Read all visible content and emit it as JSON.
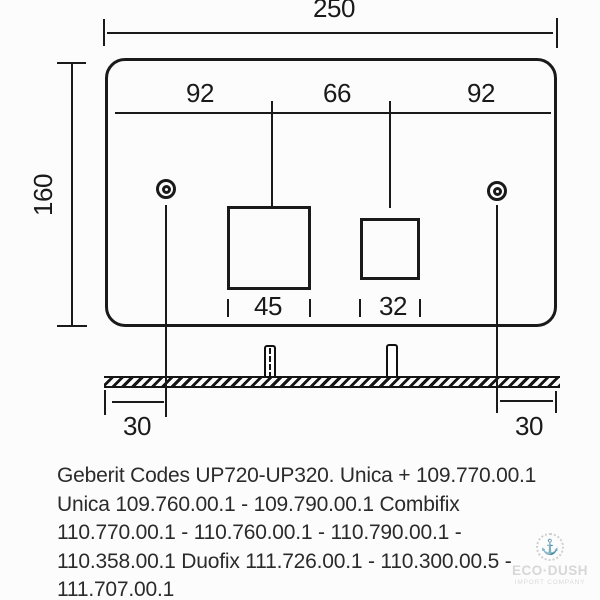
{
  "dimensions": {
    "total_width": "250",
    "total_height": "160",
    "span_left": "92",
    "span_center": "66",
    "span_right": "92",
    "cutout_large": "45",
    "cutout_small": "32",
    "offset_left": "30",
    "offset_right": "30"
  },
  "codes": {
    "lines": [
      "Geberit Codes UP720-UP320. Unica + 109.770.00.1",
      "Unica 109.760.00.1 - 109.790.00.1 Combifix",
      "110.770.00.1 - 110.760.00.1 - 110.790.00.1 -",
      "110.358.00.1 Duofix 111.726.00.1 - 110.300.00.5 -",
      "111.707.00.1"
    ]
  },
  "watermark": {
    "anchor_glyph": "⚓",
    "brand": "ECO·DUSH",
    "tagline": "IMPORT COMPANY"
  },
  "colors": {
    "line": "#1a1a1a",
    "text": "#2b2b2b",
    "watermark": "#d6d6d6",
    "background": "#fcfcfc"
  }
}
